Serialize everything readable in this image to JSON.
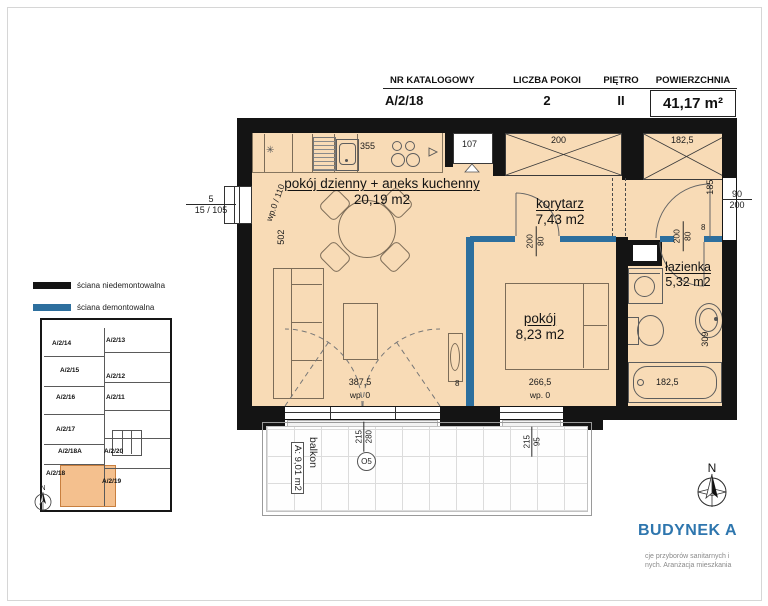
{
  "header": {
    "columns": [
      {
        "label": "NR KATALOGOWY",
        "value": "A/2/18"
      },
      {
        "label": "LICZBA POKOI",
        "value": "2"
      },
      {
        "label": "PIĘTRO",
        "value": "II"
      },
      {
        "label": "POWIERZCHNIA",
        "value": "41,17 m²"
      }
    ]
  },
  "legend": {
    "non_demountable": "ściana niedemontowalna",
    "demountable": "ściana demontowalna",
    "non_demountable_color": "#141414",
    "demountable_color": "#2d6f9e"
  },
  "rooms": {
    "living": {
      "name": "pokój dzienny + aneks kuchenny",
      "area": "20,19 m2"
    },
    "corridor": {
      "name": "korytarz",
      "area": "7,43 m2"
    },
    "bedroom": {
      "name": "pokój",
      "area": "8,23 m2"
    },
    "bathroom": {
      "name": "łazienka",
      "area": "5,32 m2"
    },
    "balcony": {
      "name": "balkon",
      "area": "A: 9,01 m2"
    }
  },
  "dims": {
    "kitchen": "355",
    "niche": "107",
    "wardrobe_1": "200",
    "wardrobe_2": "182,5",
    "living_depth": "502",
    "window_left_top": "5",
    "window_left": "15 / 105",
    "window_left_wp": "wp.0 / 110",
    "entry": "185",
    "door_w": "90",
    "door_h": "200",
    "wall_8": "8",
    "bath_door_w": "80",
    "bath_door_h": "200",
    "bed_door_w": "80",
    "bed_door_h": "200",
    "living_w": "387,5",
    "bedroom_w": "266,5",
    "gap_8": "8",
    "wp0": "wp. 0",
    "balcony_door_h": "215",
    "balcony_door_w": "280",
    "balcony_mark": "O5",
    "bed_window_h": "215",
    "bed_window_w": "95",
    "tub": "182,5",
    "bath_depth": "309"
  },
  "mini_plan": {
    "units": [
      {
        "label": "A/2/14"
      },
      {
        "label": "A/2/13"
      },
      {
        "label": "A/2/15"
      },
      {
        "label": "A/2/12"
      },
      {
        "label": "A/2/16"
      },
      {
        "label": "A/2/11"
      },
      {
        "label": "A/2/17"
      },
      {
        "label": "A/2/18A"
      },
      {
        "label": "A/2/20"
      },
      {
        "label": "A/2/18",
        "highlight": true
      },
      {
        "label": "A/2/19"
      }
    ],
    "highlight_color": "#f4c08e"
  },
  "compass": {
    "north": "N"
  },
  "footer": {
    "building": "BUDYNEK A",
    "building_color": "#2e76ae",
    "note1": "cje przyborów sanitarnych i",
    "note2": "nych. Aranżacja mieszkania"
  }
}
